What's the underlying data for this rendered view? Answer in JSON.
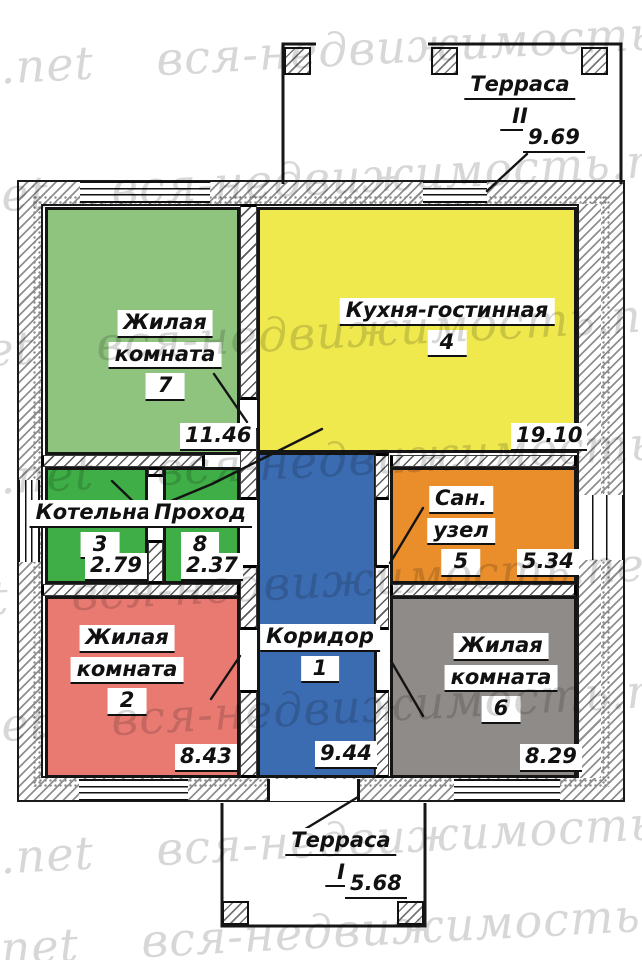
{
  "watermark": {
    "text": "вся-недвижимость.net"
  },
  "palette": {
    "living7": "#8fc47f",
    "kitchen": "#efe94e",
    "boiler": "#3fae47",
    "passage": "#3fae47",
    "bathroom": "#e98e2b",
    "living2": "#e87a72",
    "corridor": "#3b6bb0",
    "living6": "#8f8b88",
    "wall_line": "#151515",
    "watermark_gray": "#d7d7d7"
  },
  "rooms": {
    "corridor": {
      "name": "Коридор",
      "number": "1",
      "area": "9.44"
    },
    "living2": {
      "name1": "Жилая",
      "name2": "комната",
      "number": "2",
      "area": "8.43"
    },
    "boiler": {
      "name": "Котельная",
      "number": "3",
      "area": "2.79"
    },
    "kitchen": {
      "name": "Кухня-гостинная",
      "number": "4",
      "area": "19.10"
    },
    "bathroom": {
      "name1": "Сан.",
      "name2": "узел",
      "number": "5",
      "area": "5.34"
    },
    "living6": {
      "name1": "Жилая",
      "name2": "комната",
      "number": "6",
      "area": "8.29"
    },
    "living7": {
      "name1": "Жилая",
      "name2": "комната",
      "number": "7",
      "area": "11.46"
    },
    "passage": {
      "name": "Проход",
      "number": "8",
      "area": "2.37"
    }
  },
  "terraces": {
    "t1": {
      "name": "Терраса",
      "number": "I",
      "area": "5.68"
    },
    "t2": {
      "name": "Терраса",
      "number": "II",
      "area": "9.69"
    }
  }
}
